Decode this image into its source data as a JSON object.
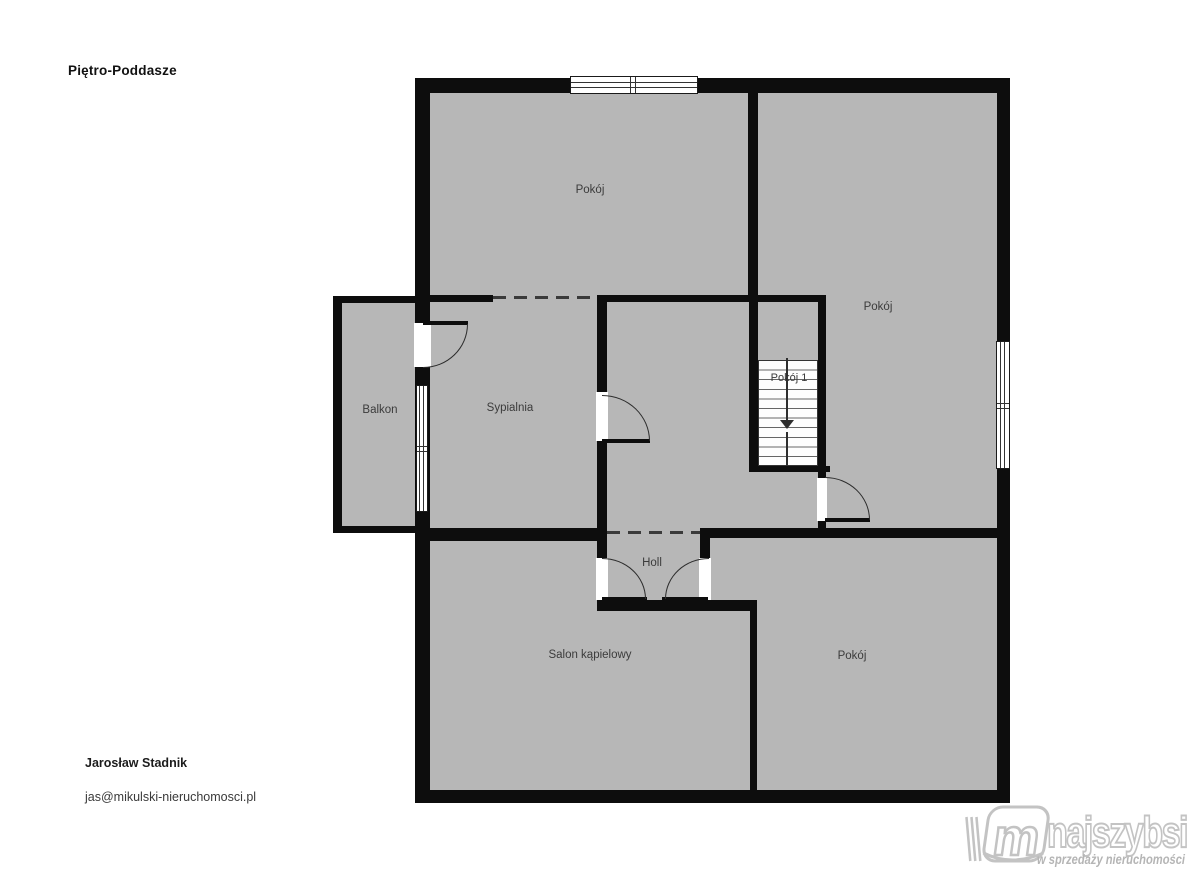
{
  "title": "Piętro-Poddasze",
  "agent": {
    "name": "Jarosław Stadnik",
    "email": "jas@mikulski-nieruchomosci.pl"
  },
  "rooms": {
    "room_top": "Pokój",
    "room_right": "Pokój",
    "sypialnia": "Sypialnia",
    "balkon": "Balkon",
    "room_1": "Pokój 1",
    "holl": "Holl",
    "salon": "Salon kąpielowy",
    "room_bottom": "Pokój"
  },
  "logo": {
    "monogram": "m",
    "brand": "najszybsi",
    "tagline": "w sprzedaży nieruchomości"
  },
  "colors": {
    "floor": "#b7b7b7",
    "wall": "#0d0d0d",
    "logo_gray": "#c3c3c3"
  }
}
